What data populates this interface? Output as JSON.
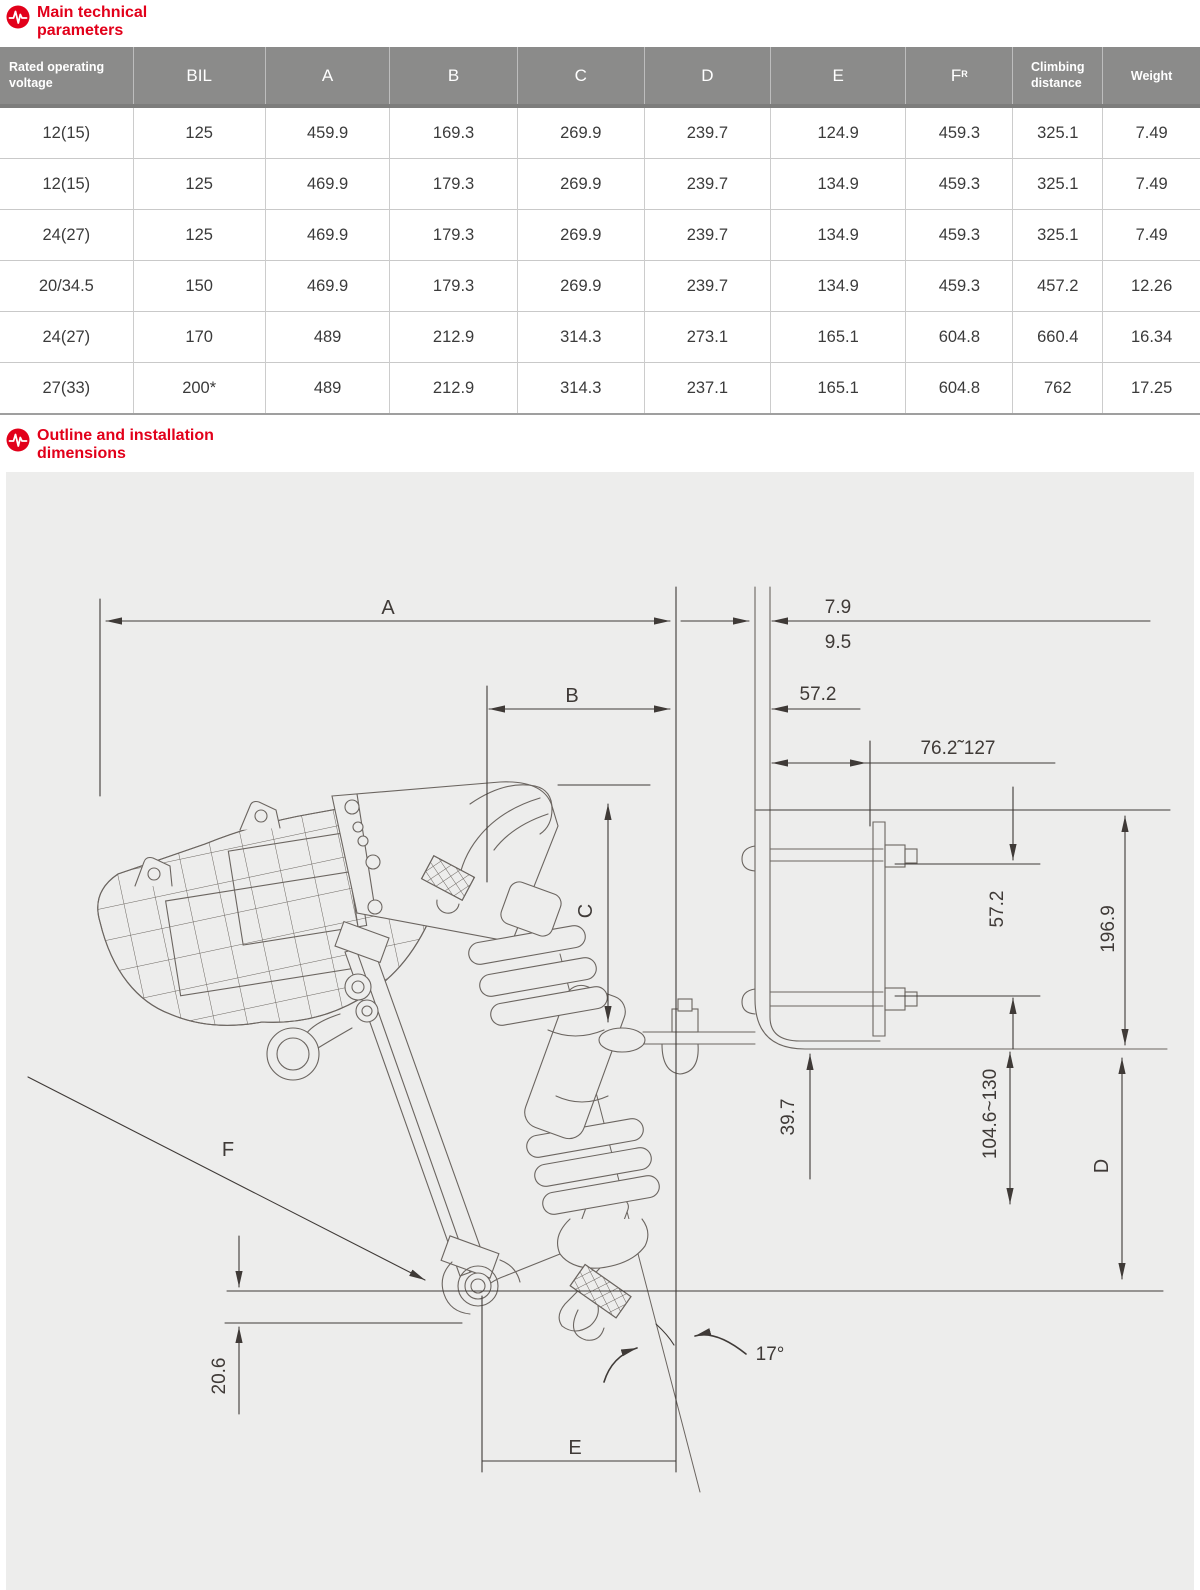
{
  "colors": {
    "accent_red": "#e2001a",
    "table_header_gray": "#8b8b8a",
    "panel_gray": "#ededec",
    "drawing_line": "#6b6560",
    "dimension_line": "#3f3a37"
  },
  "icons": {
    "pulse_icon": "red circle with white heartbeat pulse line"
  },
  "section1": {
    "title": "Main technical\nparameters"
  },
  "section2": {
    "title": "Outline and installation\ndimensions"
  },
  "table": {
    "col_widths": [
      11.1,
      11.0,
      10.4,
      10.6,
      10.6,
      10.5,
      11.3,
      8.9,
      7.5,
      8.1
    ],
    "columns": [
      {
        "t": "Rated operating voltage",
        "two_line": [
          "Rated operating",
          "voltage"
        ],
        "style": "small"
      },
      {
        "t": "BIL",
        "style": "big"
      },
      {
        "t": "A",
        "style": "big"
      },
      {
        "t": "B",
        "style": "big"
      },
      {
        "t": "C",
        "style": "big"
      },
      {
        "t": "D",
        "style": "big"
      },
      {
        "t": "E",
        "style": "big"
      },
      {
        "t": "F",
        "sup": "R",
        "style": "big"
      },
      {
        "t": "Climbing distance",
        "two_line": [
          "Climbing",
          "distance"
        ],
        "style": "small"
      },
      {
        "t": "Weight",
        "style": "small"
      }
    ],
    "rows": [
      [
        "12(15)",
        "125",
        "459.9",
        "169.3",
        "269.9",
        "239.7",
        "124.9",
        "459.3",
        "325.1",
        "7.49"
      ],
      [
        "12(15)",
        "125",
        "469.9",
        "179.3",
        "269.9",
        "239.7",
        "134.9",
        "459.3",
        "325.1",
        "7.49"
      ],
      [
        "24(27)",
        "125",
        "469.9",
        "179.3",
        "269.9",
        "239.7",
        "134.9",
        "459.3",
        "325.1",
        "7.49"
      ],
      [
        "20/34.5",
        "150",
        "469.9",
        "179.3",
        "269.9",
        "239.7",
        "134.9",
        "459.3",
        "457.2",
        "12.26"
      ],
      [
        "24(27)",
        "170",
        "489",
        "212.9",
        "314.3",
        "273.1",
        "165.1",
        "604.8",
        "660.4",
        "16.34"
      ],
      [
        "27(33)",
        "200*",
        "489",
        "212.9",
        "314.3",
        "237.1",
        "165.1",
        "604.8",
        "762",
        "17.25"
      ]
    ]
  },
  "diagram": {
    "dims": {
      "a": "A",
      "b": "B",
      "c": "C",
      "d": "D",
      "e": "E",
      "f": "F",
      "gap_top": "7.9",
      "gap_bottom": "9.5",
      "top_offset": "57.2",
      "slot_range": "76.2˜127",
      "bolt_spacing": "57.2",
      "bracket_height": "196.9",
      "drop": "39.7",
      "adjust_range": "104.6~130",
      "pivot_offset": "20.6",
      "tilt_angle": "17°"
    }
  }
}
